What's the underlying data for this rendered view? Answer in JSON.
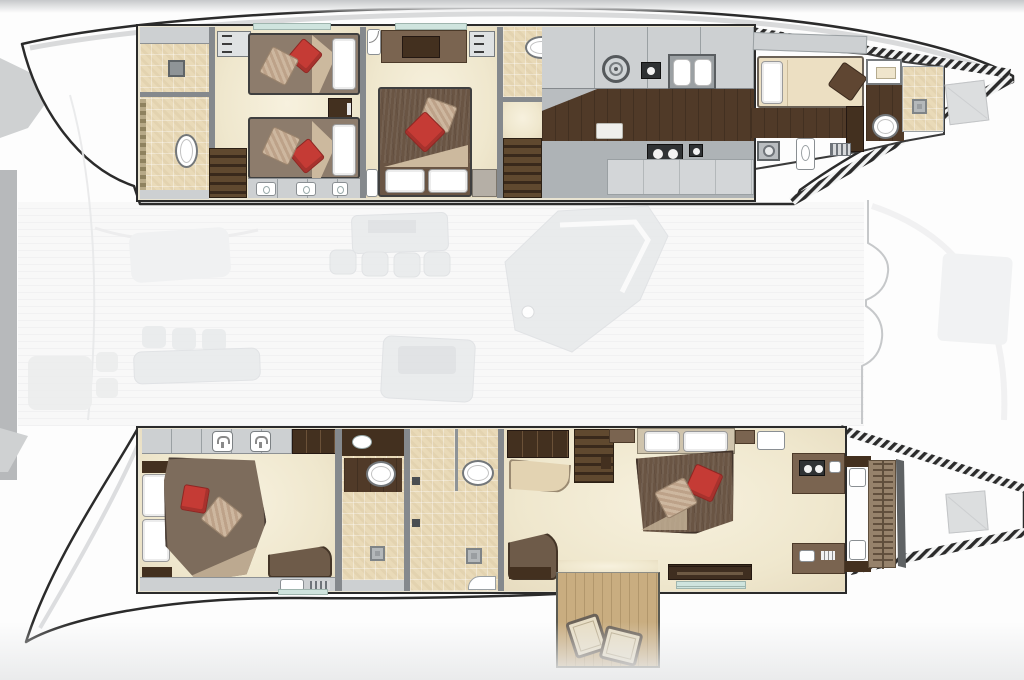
{
  "meta": {
    "title": "Catamaran yacht accommodation deck plan",
    "view": "top-down floor plan, no visible text labels"
  },
  "colors": {
    "hull_outline": "#2b2b2b",
    "wall_gray": "#85898d",
    "wall_light": "#c7cbce",
    "floor_cream": "#efe8d1",
    "tile_sand": "#e9dab8",
    "wood_dark": "#43301f",
    "wood_mid": "#7a6450",
    "walkway_wood": "#503a28",
    "bed_brown": "#8d7c6c",
    "bed_dark_brown": "#6a5544",
    "pillow_red": "#c53b35",
    "pillow_tan": "#c8b29b",
    "linen_white": "#ffffff",
    "teak": "#c9ad80",
    "teak_line": "#b2976c",
    "window_teal": "#cfe4de",
    "faded_furniture": "#e9ebec",
    "faded_line": "#dfe1e4",
    "deck_white": "#fcfcfc",
    "hatch_fill": "#d9dbdd"
  },
  "vessel": {
    "port_hull": {
      "label": "Port hull (top)",
      "rooms": [
        {
          "name": "Aft bathroom with shower and toilet"
        },
        {
          "name": "Twin guest cabin with two single berths"
        },
        {
          "name": "VIP double guest cabin"
        },
        {
          "name": "Guest bathroom with toilet and shower"
        },
        {
          "name": "Companionway stairs"
        },
        {
          "name": "Galley with burner, double sink and cooktop"
        },
        {
          "name": "Crew cabin with berth"
        },
        {
          "name": "Crew bathroom with shower"
        },
        {
          "name": "Bow deck hatch"
        }
      ]
    },
    "starboard_hull": {
      "label": "Starboard hull (bottom)",
      "rooms": [
        {
          "name": "Aft guest double cabin"
        },
        {
          "name": "En-suite bathroom"
        },
        {
          "name": "Master bathroom with shower"
        },
        {
          "name": "Master suite with vanities and sofa"
        },
        {
          "name": "Walk-in hanging wardrobe"
        },
        {
          "name": "Bow deck hatch"
        },
        {
          "name": "Aft teak platform with two deck chairs"
        }
      ]
    },
    "main_deck": {
      "label": "Main deck saloon shown faded beneath hull plans",
      "items": [
        "Dining table with four chairs",
        "Saloon seating group",
        "Navigation and galley unit",
        "Aft swim platform",
        "Foredeck between hulls"
      ]
    }
  }
}
